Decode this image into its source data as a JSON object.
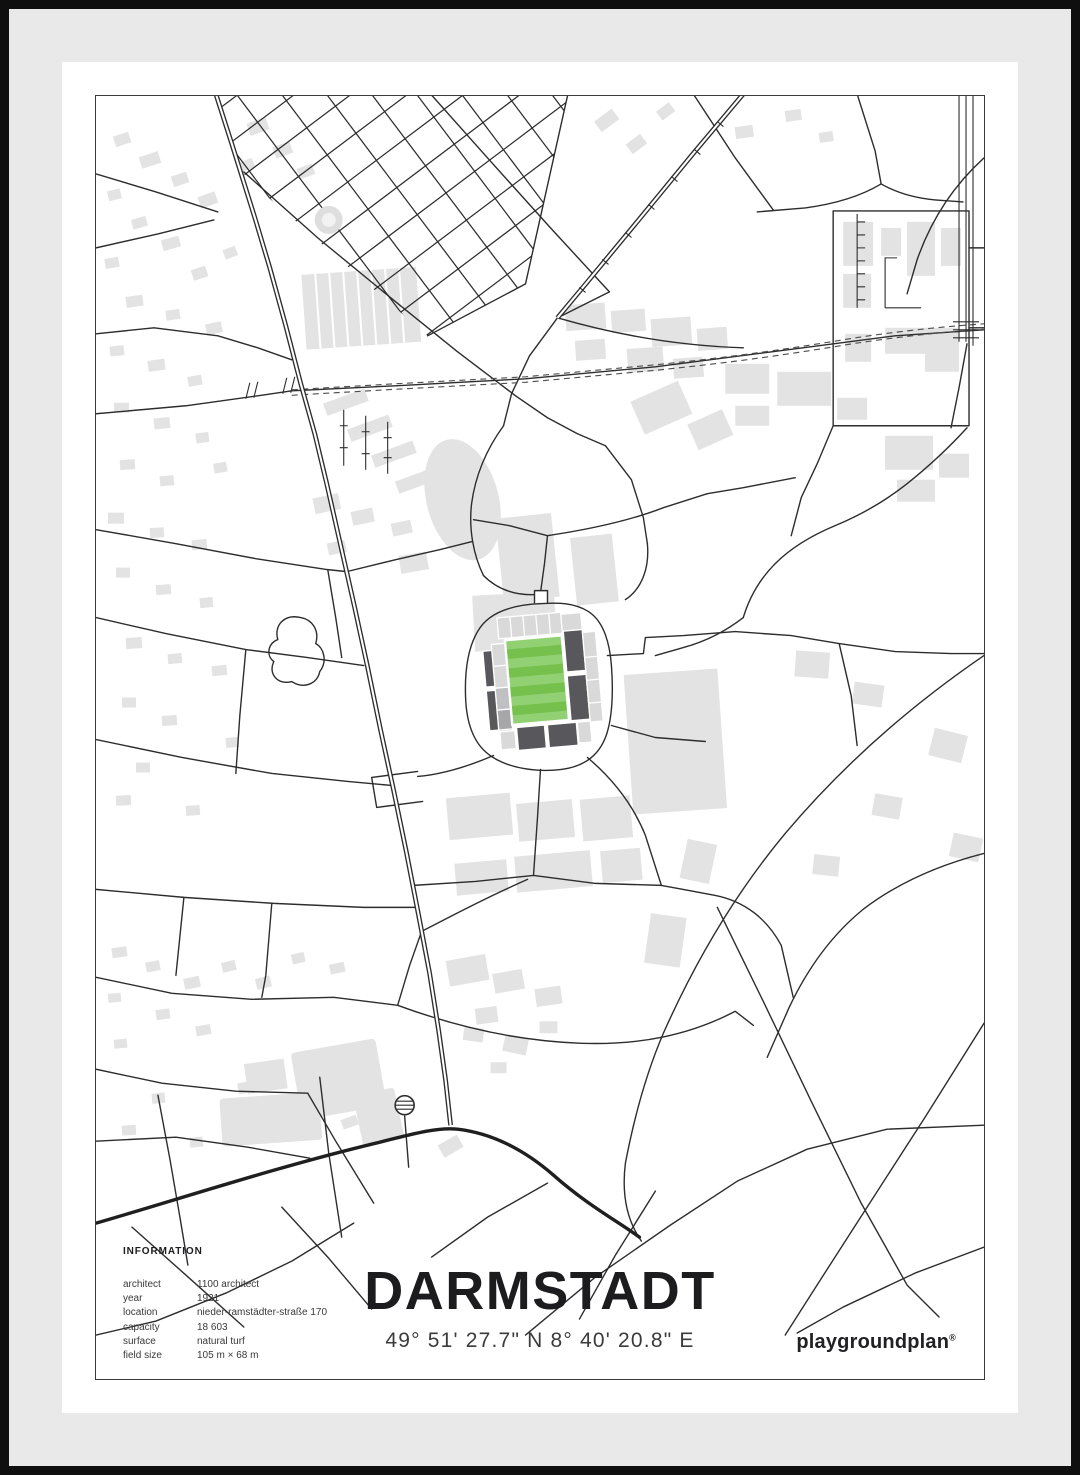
{
  "poster": {
    "title": "DARMSTADT",
    "coordinates": "49° 51' 27.7\" N  8° 40' 20.8\" E",
    "brand": "playgroundplan",
    "brand_mark": "®",
    "info": {
      "heading": "INFORMATION",
      "rows": [
        {
          "label": "architect",
          "value": "1100 architect"
        },
        {
          "label": "year",
          "value": "1921"
        },
        {
          "label": "location",
          "value": "nieder-ramstädter-straße 170"
        },
        {
          "label": "capacity",
          "value": "18 603"
        },
        {
          "label": "surface",
          "value": "natural turf"
        },
        {
          "label": "field size",
          "value": "105 m × 68 m"
        }
      ]
    }
  },
  "map": {
    "subject": "street map with football stadium highlighted in green",
    "features": [
      "park-garden-grid",
      "railway-dashed-line",
      "main-road",
      "stadium-with-green-pitch",
      "athletics-track",
      "water-tower",
      "building-footprints"
    ]
  },
  "theme": {
    "frame": "#0f0f0f",
    "mat_gray": "#e9e9e9",
    "mat_white": "#ffffff",
    "map_border": "#3a3a3a",
    "road": "#2d2d2d",
    "building": "#e3e3e4",
    "pitch_green": "#76c14e",
    "pitch_green_light": "#92d173",
    "stand_dark": "#58585c",
    "stand_light": "#d9d9da",
    "text_dark": "#1c1c1e",
    "text_mid": "#3b3b3d"
  }
}
